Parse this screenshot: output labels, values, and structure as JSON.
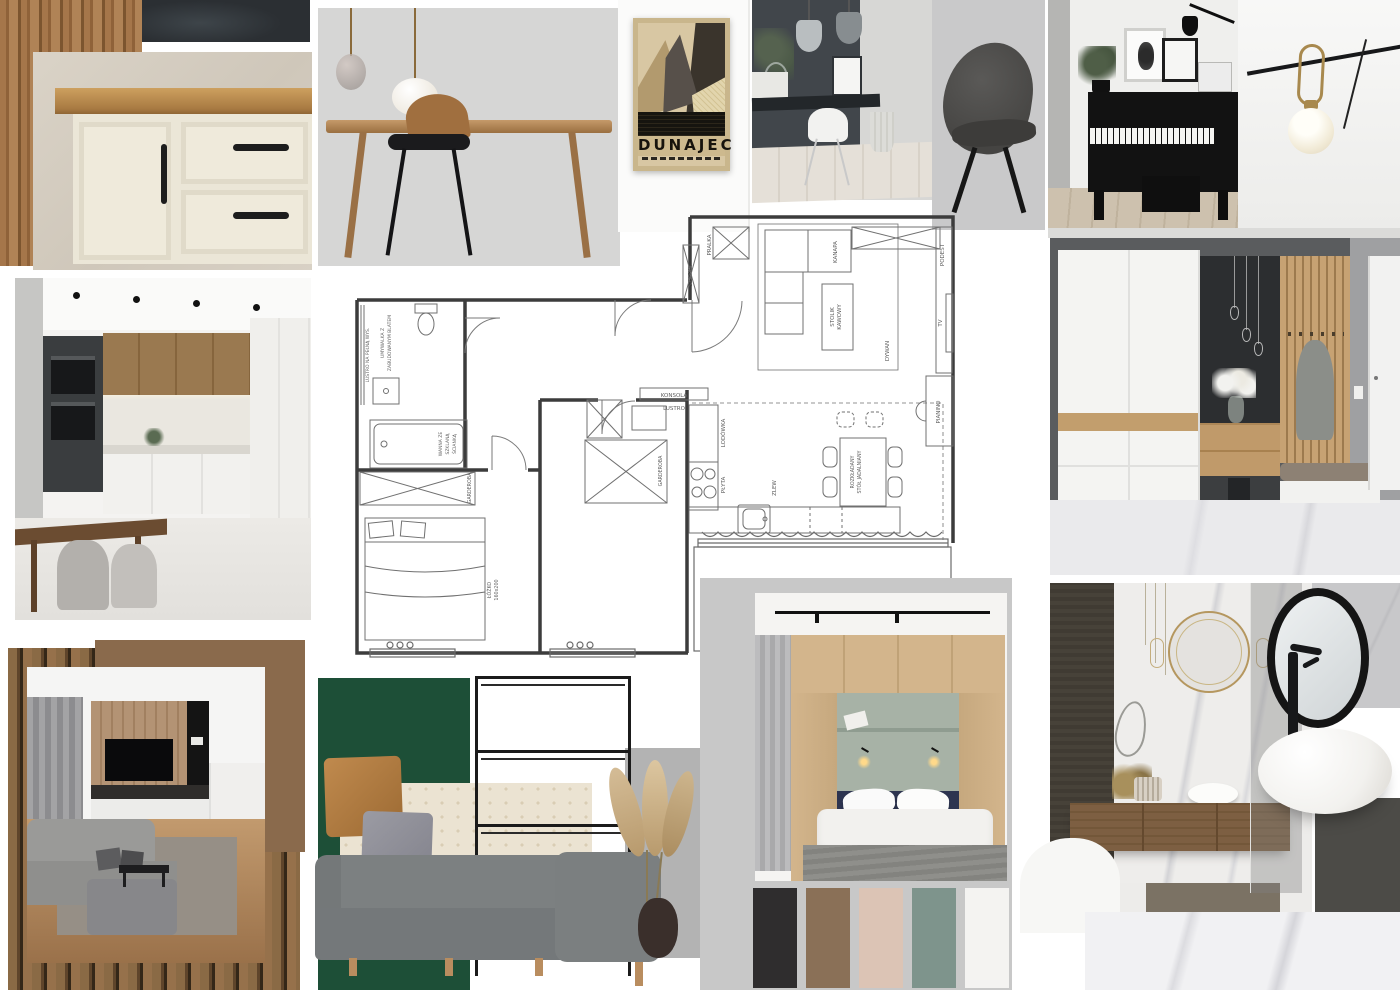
{
  "poster": {
    "title": "DUNAJEC"
  },
  "floorplan": {
    "labels": {
      "pralka": "PRALKA",
      "szafka": "SZAFKA",
      "kanapa": "KANAPA",
      "podest": "PODEST",
      "tv": "TV",
      "stolik1": "STOLIK",
      "stolik2": "KAWOWY",
      "dywan": "DYWAN",
      "pianino": "PIANINO",
      "lodowka": "LODÓWKA",
      "plyta": "PŁYTA",
      "zlew": "ZLEW",
      "stol1": "ROZKŁADANY",
      "stol2": "STÓŁ JADALNIANY",
      "konsola": "KONSOLA",
      "lustro": "LUSTRO",
      "lustro_wys": "LUSTRO NA PEŁNĄ WYS.",
      "umywalka1": "UMYWALKA Z",
      "umywalka2": "ZABUDOWANYM BLATEM",
      "wanna1": "WANNA ZE",
      "wanna2": "SZKLANĄ",
      "wanna3": "ŚCIANKĄ",
      "garderoba_a": "GARDEROBA",
      "garderoba_b": "GARDEROBA",
      "lozko1": "ŁÓŻKO",
      "lozko2": "160x200"
    }
  },
  "palette": {
    "swatches": [
      "#2F2D2E",
      "#8A7057",
      "#DCC4B5",
      "#7E948C",
      "#F4F3F1"
    ]
  },
  "board": {
    "green_block": "#1D4F37",
    "brown_block": "#8A6A4C"
  }
}
